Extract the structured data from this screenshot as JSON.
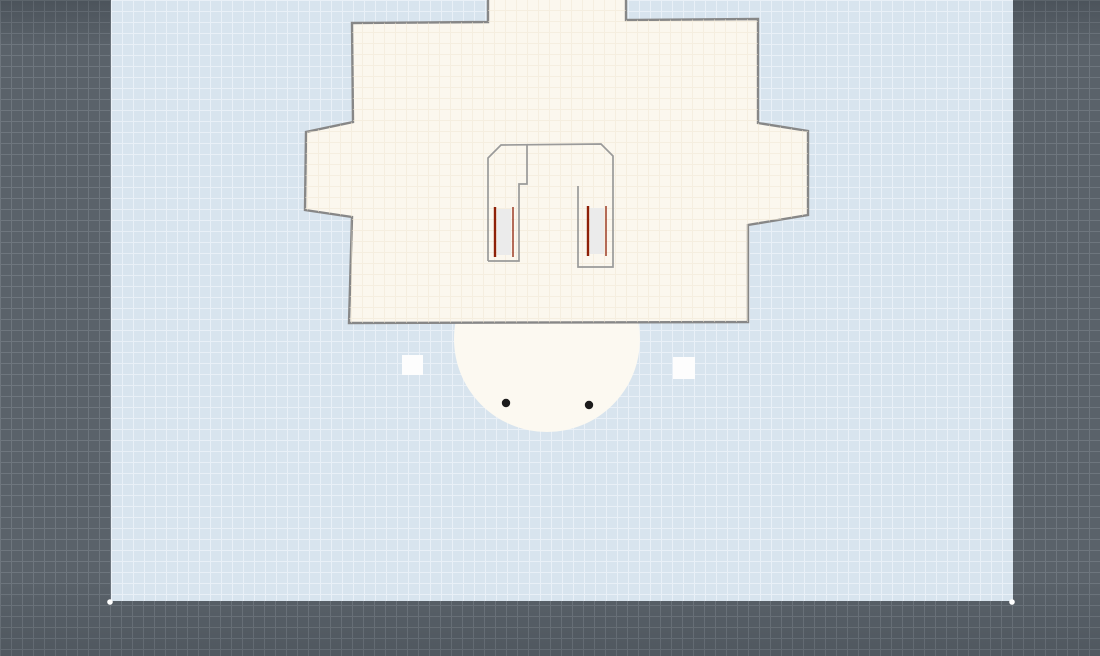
{
  "scene": {
    "colors": {
      "frame_bg": "#5a626a",
      "frame_grid": "#6e767e",
      "canvas_bg": "#d8e4ee",
      "canvas_grid": "#e9f0f7",
      "body_fill": "#fbf7ee",
      "dome_fill": "#fcf9f1",
      "outline": "#878787",
      "inner_line": "#9a9a9a",
      "slot_fill": "#ebebeb",
      "heat_line": "#8e2007",
      "marker_white": "#fdfdfd",
      "dot_black": "#1c1c1c",
      "handle_white": "#ffffff"
    },
    "canvas_rect": {
      "x": 111,
      "y": 0,
      "width": 902,
      "height": 601
    },
    "grid_cell_px": 11,
    "body": {
      "points": "352,23 488,22 488,-4 626,-4 626,20 758,19 758,123 808,131 808,215 748,225 748,322 349,323 352,217 305,210 306,132 353,122"
    },
    "inner_outline": {
      "points": "488,261 488,158 501,145 601,144 613,156 613,267 578,267 578,186"
    },
    "inner_step": {
      "points": "527,144 527,184 519,184 519,261 488,261"
    },
    "slot_left_rect": {
      "x": 497,
      "y": 209,
      "width": 14,
      "height": 46
    },
    "slot_left_line_a": {
      "x1": 495,
      "y1": 207,
      "x2": 495,
      "y2": 257
    },
    "slot_left_line_b": {
      "x1": 513,
      "y1": 207,
      "x2": 513,
      "y2": 257
    },
    "slot_right_rect": {
      "x": 590,
      "y": 208,
      "width": 14,
      "height": 46
    },
    "slot_right_line_a": {
      "x1": 588,
      "y1": 206,
      "x2": 588,
      "y2": 256
    },
    "slot_right_line_b": {
      "x1": 606,
      "y1": 206,
      "x2": 606,
      "y2": 256
    },
    "dome": {
      "cx": 547,
      "cy": 339,
      "r": 93
    },
    "dot_left": {
      "cx": 506,
      "cy": 403,
      "r": 4.2
    },
    "dot_right": {
      "cx": 589,
      "cy": 405,
      "r": 4.2
    },
    "marker_left": {
      "x": 402,
      "y": 355,
      "width": 21,
      "height": 20
    },
    "marker_right": {
      "x": 673,
      "y": 357,
      "width": 22,
      "height": 22
    },
    "handle_left": {
      "cx": 110,
      "cy": 602,
      "r": 2.8
    },
    "handle_right": {
      "cx": 1012,
      "cy": 602,
      "r": 2.8
    }
  }
}
